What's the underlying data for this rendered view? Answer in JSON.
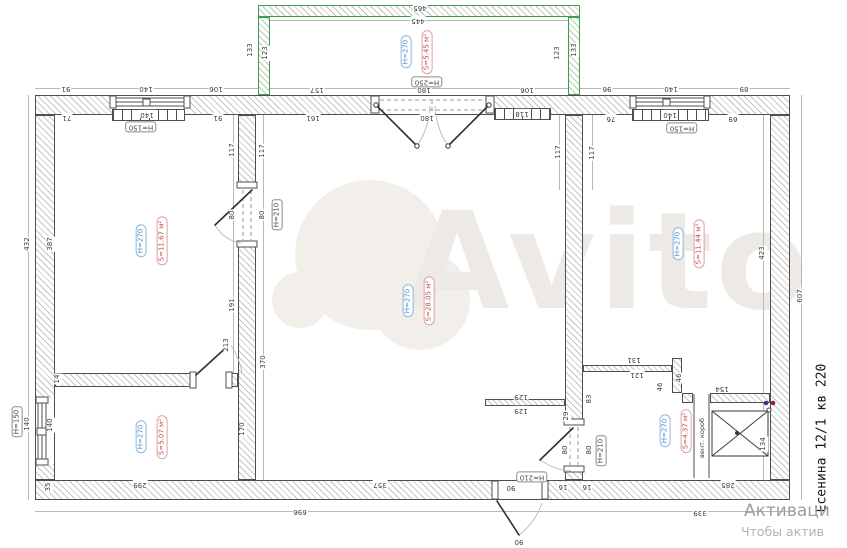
{
  "address_label": "Есенина 12/1 кв 220",
  "watermark_text": "Avito",
  "activation": {
    "line1": "Активаци",
    "line2": "Чтобы актив"
  },
  "vent_label": "вент. короб",
  "colors": {
    "height_label_blue": "#4f8fcc",
    "area_label_red": "#c0504d",
    "balcony_green": "#3f9e4c"
  },
  "rooms": [
    {
      "name": "balcony",
      "h": "H=270",
      "s": "S=5.45 м²",
      "x": 406,
      "y": 52
    },
    {
      "name": "room-left",
      "h": "H=270",
      "s": "S=11.67 м²",
      "x": 141,
      "y": 241
    },
    {
      "name": "room-center",
      "h": "H=270",
      "s": "S=28.05 м²",
      "x": 408,
      "y": 301
    },
    {
      "name": "room-right",
      "h": "H=270",
      "s": "S=11.44 м²",
      "x": 678,
      "y": 244
    },
    {
      "name": "room-bottom-left",
      "h": "H=270",
      "s": "S=5.07 м²",
      "x": 141,
      "y": 437
    },
    {
      "name": "room-bottom-right",
      "h": "H=270",
      "s": "S=4.37 м²",
      "x": 665,
      "y": 431
    }
  ],
  "boxed_labels": [
    {
      "t": "H=250",
      "x": 427,
      "y": 82,
      "r": "f"
    },
    {
      "t": "H=150",
      "x": 141,
      "y": 127,
      "r": "f"
    },
    {
      "t": "H=150",
      "x": 682,
      "y": 128,
      "r": "f"
    },
    {
      "t": "H=150",
      "x": 17,
      "y": 422,
      "r": "v"
    },
    {
      "t": "H=210",
      "x": 277,
      "y": 215,
      "r": "v"
    },
    {
      "t": "H=210",
      "x": 601,
      "y": 451,
      "r": "v"
    },
    {
      "t": "H=210",
      "x": 532,
      "y": 477,
      "r": "f"
    }
  ],
  "dimensions": [
    {
      "t": "465",
      "x": 420,
      "y": 7,
      "r": "f"
    },
    {
      "t": "445",
      "x": 418,
      "y": 20,
      "r": "f"
    },
    {
      "t": "133",
      "x": 251,
      "y": 50,
      "r": "v"
    },
    {
      "t": "123",
      "x": 266,
      "y": 53,
      "r": "v"
    },
    {
      "t": "123",
      "x": 558,
      "y": 53,
      "r": "v"
    },
    {
      "t": "133",
      "x": 575,
      "y": 50,
      "r": "v"
    },
    {
      "t": "91",
      "x": 66,
      "y": 88,
      "r": "f"
    },
    {
      "t": "140",
      "x": 146,
      "y": 88,
      "r": "f"
    },
    {
      "t": "106",
      "x": 216,
      "y": 88,
      "r": "f"
    },
    {
      "t": "157",
      "x": 317,
      "y": 89,
      "r": "f"
    },
    {
      "t": "180",
      "x": 424,
      "y": 89,
      "r": "f"
    },
    {
      "t": "106",
      "x": 527,
      "y": 89,
      "r": "f"
    },
    {
      "t": "96",
      "x": 607,
      "y": 88,
      "r": "f"
    },
    {
      "t": "140",
      "x": 671,
      "y": 88,
      "r": "f"
    },
    {
      "t": "89",
      "x": 744,
      "y": 88,
      "r": "f"
    },
    {
      "t": "71",
      "x": 67,
      "y": 117,
      "r": "f"
    },
    {
      "t": "140",
      "x": 147,
      "y": 114,
      "r": "f"
    },
    {
      "t": "91",
      "x": 218,
      "y": 117,
      "r": "f"
    },
    {
      "t": "161",
      "x": 313,
      "y": 117,
      "r": "f"
    },
    {
      "t": "180",
      "x": 427,
      "y": 117,
      "r": "f"
    },
    {
      "t": "118",
      "x": 522,
      "y": 113,
      "r": "f"
    },
    {
      "t": "76",
      "x": 611,
      "y": 118,
      "r": "f"
    },
    {
      "t": "140",
      "x": 670,
      "y": 114,
      "r": "f"
    },
    {
      "t": "69",
      "x": 733,
      "y": 118,
      "r": "f"
    },
    {
      "t": "117",
      "x": 233,
      "y": 150,
      "r": "v"
    },
    {
      "t": "117",
      "x": 263,
      "y": 151,
      "r": "v"
    },
    {
      "t": "80",
      "x": 233,
      "y": 215,
      "r": "v"
    },
    {
      "t": "80",
      "x": 263,
      "y": 215,
      "r": "v"
    },
    {
      "t": "191",
      "x": 233,
      "y": 305,
      "r": "v"
    },
    {
      "t": "213",
      "x": 227,
      "y": 345,
      "r": "v"
    },
    {
      "t": "370",
      "x": 264,
      "y": 362,
      "r": "v"
    },
    {
      "t": "432",
      "x": 28,
      "y": 244,
      "r": "v"
    },
    {
      "t": "387",
      "x": 51,
      "y": 244,
      "r": "v"
    },
    {
      "t": "14",
      "x": 58,
      "y": 379,
      "r": "v"
    },
    {
      "t": "140",
      "x": 28,
      "y": 424,
      "r": "v"
    },
    {
      "t": "140",
      "x": 51,
      "y": 425,
      "r": "v"
    },
    {
      "t": "35",
      "x": 49,
      "y": 487,
      "r": "v"
    },
    {
      "t": "170",
      "x": 243,
      "y": 429,
      "r": "v"
    },
    {
      "t": "117",
      "x": 559,
      "y": 152,
      "r": "v"
    },
    {
      "t": "117",
      "x": 593,
      "y": 153,
      "r": "v"
    },
    {
      "t": "129",
      "x": 521,
      "y": 396,
      "r": "f"
    },
    {
      "t": "129",
      "x": 521,
      "y": 410,
      "r": "f"
    },
    {
      "t": "83",
      "x": 590,
      "y": 399,
      "r": "v"
    },
    {
      "t": "29",
      "x": 567,
      "y": 416,
      "r": "v"
    },
    {
      "t": "80",
      "x": 566,
      "y": 450,
      "r": "v"
    },
    {
      "t": "80",
      "x": 590,
      "y": 450,
      "r": "v"
    },
    {
      "t": "131",
      "x": 634,
      "y": 359,
      "r": "f"
    },
    {
      "t": "121",
      "x": 637,
      "y": 374,
      "r": "f"
    },
    {
      "t": "46",
      "x": 661,
      "y": 387,
      "r": "v"
    },
    {
      "t": "46",
      "x": 680,
      "y": 378,
      "r": "v"
    },
    {
      "t": "154",
      "x": 722,
      "y": 388,
      "r": "f"
    },
    {
      "t": "134",
      "x": 764,
      "y": 444,
      "r": "v"
    },
    {
      "t": "423",
      "x": 763,
      "y": 253,
      "r": "v"
    },
    {
      "t": "607",
      "x": 801,
      "y": 296,
      "r": "v"
    },
    {
      "t": "299",
      "x": 140,
      "y": 484,
      "r": "f"
    },
    {
      "t": "357",
      "x": 380,
      "y": 484,
      "r": "f"
    },
    {
      "t": "90",
      "x": 511,
      "y": 487,
      "r": "f"
    },
    {
      "t": "16",
      "x": 563,
      "y": 486,
      "r": "f"
    },
    {
      "t": "16",
      "x": 587,
      "y": 486,
      "r": "f"
    },
    {
      "t": "285",
      "x": 728,
      "y": 484,
      "r": "f"
    },
    {
      "t": "696",
      "x": 300,
      "y": 511,
      "r": "f"
    },
    {
      "t": "339",
      "x": 700,
      "y": 512,
      "r": "f"
    },
    {
      "t": "90",
      "x": 519,
      "y": 541,
      "r": "f"
    }
  ]
}
